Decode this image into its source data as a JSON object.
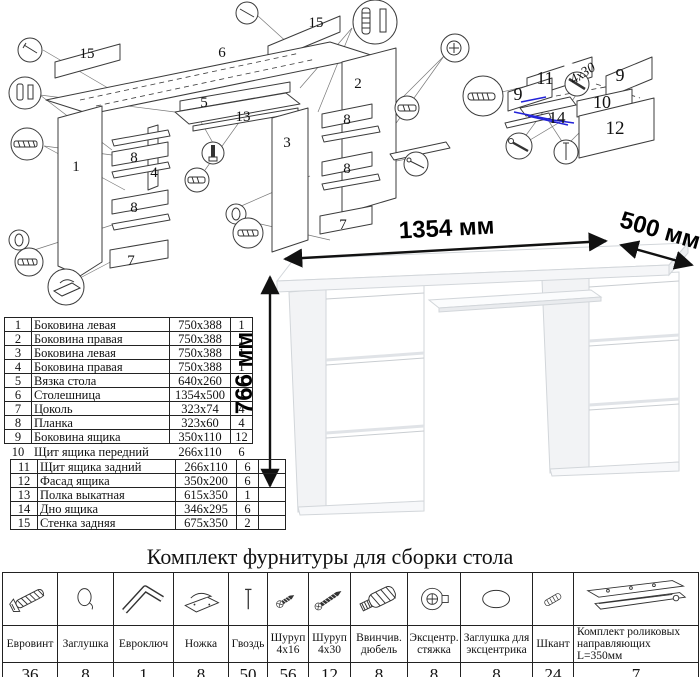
{
  "page": {
    "background": "#ffffff",
    "accent_blue": "#2323d8"
  },
  "dimensions": {
    "width": "1354 мм",
    "depth": "500 мм",
    "height": "766 мм"
  },
  "exploded_view": {
    "labels": [
      {
        "t": "15",
        "x": 87,
        "y": 58
      },
      {
        "t": "6",
        "x": 222,
        "y": 57
      },
      {
        "t": "15",
        "x": 316,
        "y": 27
      },
      {
        "t": "5",
        "x": 204,
        "y": 107
      },
      {
        "t": "13",
        "x": 243,
        "y": 121
      },
      {
        "t": "1",
        "x": 76,
        "y": 171
      },
      {
        "t": "8",
        "x": 134,
        "y": 162
      },
      {
        "t": "4",
        "x": 154,
        "y": 177
      },
      {
        "t": "8",
        "x": 134,
        "y": 212
      },
      {
        "t": "7",
        "x": 131,
        "y": 265
      },
      {
        "t": "3",
        "x": 287,
        "y": 147
      },
      {
        "t": "2",
        "x": 358,
        "y": 88
      },
      {
        "t": "8",
        "x": 347,
        "y": 124
      },
      {
        "t": "8",
        "x": 347,
        "y": 173
      },
      {
        "t": "7",
        "x": 343,
        "y": 229
      }
    ]
  },
  "drawer_view": {
    "labels": [
      {
        "t": "11",
        "x": 545,
        "y": 84,
        "s": 18
      },
      {
        "t": "9",
        "x": 620,
        "y": 81,
        "s": 18
      },
      {
        "t": "9",
        "x": 518,
        "y": 100,
        "s": 18
      },
      {
        "t": "10",
        "x": 602,
        "y": 108,
        "s": 18
      },
      {
        "t": "14",
        "x": 557,
        "y": 123,
        "s": 17
      },
      {
        "t": "12",
        "x": 615,
        "y": 134,
        "s": 19
      },
      {
        "t": "4x30",
        "x": 585,
        "y": 77,
        "s": 14,
        "r": -33,
        "i": true
      }
    ]
  },
  "parts_table": {
    "rows": [
      [
        "1",
        "Боковина левая",
        "750x388",
        "1"
      ],
      [
        "2",
        "Боковина правая",
        "750x388",
        "1"
      ],
      [
        "3",
        "Боковина левая",
        "750x388",
        "1"
      ],
      [
        "4",
        "Боковина правая",
        "750x388",
        "1"
      ],
      [
        "5",
        "Вязка стола",
        "640x260",
        "1"
      ],
      [
        "6",
        "Столешница",
        "1354x500",
        "1"
      ],
      [
        "7",
        "Цоколь",
        "323x74",
        "4"
      ],
      [
        "8",
        "Планка",
        "323x60",
        "4"
      ],
      [
        "9",
        "Боковина ящика",
        "350x110",
        "12"
      ],
      [
        "10",
        "Щит ящика передний",
        "266x110",
        "6"
      ],
      [
        "11",
        "Щит ящика задний",
        "266x110",
        "6"
      ],
      [
        "12",
        "Фасад ящика",
        "350x200",
        "6"
      ],
      [
        "13",
        "Полка выкатная",
        "615x350",
        "1"
      ],
      [
        "14",
        "Дно ящика",
        "346x295",
        "6"
      ],
      [
        "15",
        "Стенка задняя",
        "675x350",
        "2"
      ]
    ]
  },
  "hardware": {
    "title": "Комплект фурнитуры для сборки стола",
    "items": [
      {
        "name": "Евровинт",
        "qty": "36",
        "icon": "euroscrew-icon"
      },
      {
        "name": "Заглушка",
        "qty": "8",
        "icon": "cap-icon"
      },
      {
        "name": "Евроключ",
        "qty": "1",
        "icon": "hexkey-icon"
      },
      {
        "name": "Ножка",
        "qty": "8",
        "icon": "foot-icon"
      },
      {
        "name": "Гвоздь",
        "qty": "50",
        "icon": "nail-icon"
      },
      {
        "name": "Шуруп 4x16",
        "qty": "56",
        "icon": "screw-short-icon"
      },
      {
        "name": "Шуруп 4x30",
        "qty": "12",
        "icon": "screw-long-icon"
      },
      {
        "name": "Ввинчив. дюбель",
        "qty": "8",
        "icon": "dowel-icon"
      },
      {
        "name": "Эксцентр. стяжка",
        "qty": "8",
        "icon": "cam-icon"
      },
      {
        "name": "Заглушка для эксцентрика",
        "qty": "8",
        "icon": "cam-cap-icon"
      },
      {
        "name": "Шкант",
        "qty": "24",
        "icon": "shkant-icon"
      },
      {
        "name": "Комплект роликовых направляющих L=350мм",
        "qty": "7",
        "icon": "rail-icon"
      }
    ]
  }
}
